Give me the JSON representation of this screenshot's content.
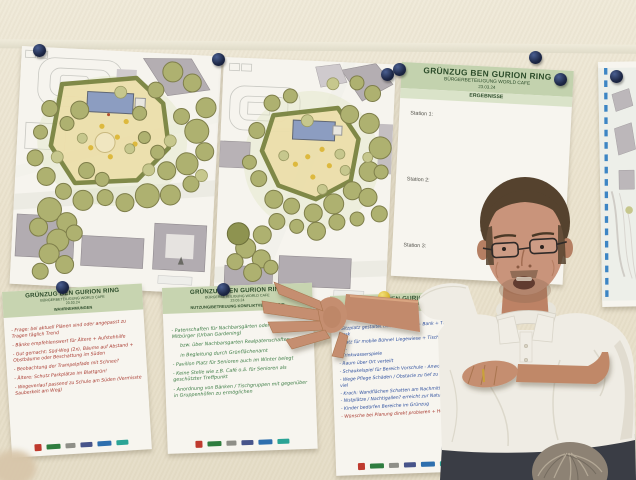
{
  "colors": {
    "header_band": "#c7d4b0",
    "header_text": "#2c4c2a",
    "ink_red": "#a8392f",
    "ink_green": "#3c7c44",
    "ink_blue": "#2d4f9e",
    "pin_navy": "#232e4c",
    "pin_yellow": "#e2c23c",
    "wall": "#eae2cd"
  },
  "results_poster": {
    "title": "GRÜNZUG BEN GURION RING",
    "subtitle": "BÜRGERBETEILIGUNG WORLD CAFE",
    "date": "23.03.24",
    "section": "ERGEBNISSE",
    "stations": [
      "Station 1:",
      "Station 2:",
      "Station 3:"
    ]
  },
  "flipchart_left": {
    "title": "GRÜNZUG BEN GURION RING",
    "subtitle": "BÜRGERBETEILIGUNG WORLD CAFE",
    "date": "23.03.24",
    "section": "WAHRNEHMUNGEN",
    "lines": [
      "- Frage: bei aktuell Plänen sind oder angepasst zu Tragen täglich Trend",
      "- Bänke empfehlenswert für Ältere + Aufstehhilfe",
      "- Gut gemacht: Süd-Weg (2x), Bäume auf Abstand + Obstbäume oder Beschattung im Süden",
      "- Beobachtung der Trampelpfade mit Schnee?",
      "- Ältere: Schutz Parkplätze im Blattgrün!",
      "- Wegeverlauf passend zu Schule am Süden (Vermisste Sauberkeit am Weg)"
    ]
  },
  "flipchart_middle": {
    "title": "GRÜNZUG BEN GURION RING",
    "subtitle": "BÜRGERBETEILIGUNG WORLD CAFE",
    "date": "23.03.24",
    "section": "NUTZUNG/BETREUUNG KONFLIKTVERMEIDUNG",
    "lines": [
      "- Patenschaften für Nachbarsgärten oder Pflege für Mitbürger (Urban Gardening)",
      "bzw. über Nachbarsgarten Realpatenschaften",
      "in Begleitung durch Grünflächenamt",
      "- Pavillon Platz für Senioren auch im Winter belegt",
      "- Keine Stelle wie z.B. Café o.ä. für Senioren als geschützter Treffpunkt",
      "- Anordnung von Bänken / Tischgruppen mit gegenüber in Gruppenhöfen zu ermöglichen"
    ]
  },
  "flipchart_right": {
    "title": "GRÜNZUG BEN GURION RING",
    "subtitle": "BÜRGERBETEILIGUNG WORLD CAFE",
    "date": "23.03.24",
    "lines": [
      "- Sitzplatz gestaltet (Wasserspiel?) + Bank + Tisch + Kiosk",
      "- Platz für mobile Bühne! Liegewiese + Tischtennis o.ä.",
      "- Trinkwasserspiele",
      "- Raum über Ort verteilt",
      "- Schaukelspiel für Bereich Vorschule - Anwohner",
      "- Wege Pflege Schäden / Obstacle zu tief zu dicht zu viel",
      "- Krach: Wandflächen Schatten am Nachmittag",
      "- Nistplätze / Nachtigallen? erreicht zur Natur",
      "- Kinder bedürfen Bereiche im Grünzug"
    ],
    "highlight_line": "- Wünsche bei Planung direkt probieren + Höhe"
  }
}
